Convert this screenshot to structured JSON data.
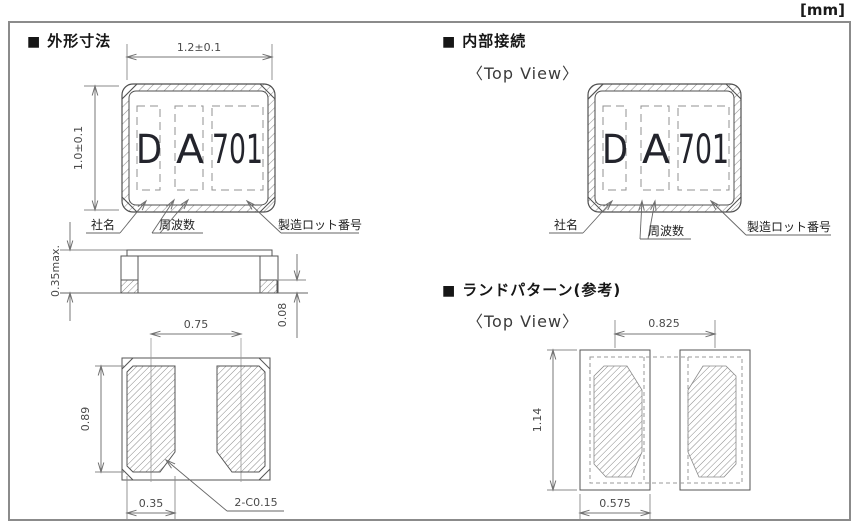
{
  "unit_label": "[mm]",
  "sections": {
    "outline": {
      "marker": "■",
      "title": "外形寸法",
      "package_marking": {
        "company_code": "D",
        "frequency_code": "A",
        "lot_code": "701"
      },
      "labels": {
        "company": "社名",
        "frequency": "周波数",
        "lot": "製造ロット番号"
      },
      "dimensions": {
        "body_width": "1.2±0.1",
        "body_height": "1.0±0.1",
        "thickness": "0.35max.",
        "electrode_height": "0.08",
        "pad_pitch": "0.75",
        "pad_length": "0.89",
        "pad_width": "0.35",
        "chamfer": "2-C0.15"
      }
    },
    "internal_connection": {
      "marker": "■",
      "title": "内部接続",
      "view_label": "〈Top View〉",
      "package_marking": {
        "company_code": "D",
        "frequency_code": "A",
        "lot_code": "701"
      },
      "labels": {
        "company": "社名",
        "frequency": "周波数",
        "lot": "製造ロット番号"
      }
    },
    "land_pattern": {
      "marker": "■",
      "title": "ランドパターン(参考)",
      "view_label": "〈Top View〉",
      "dimensions": {
        "pad_pitch": "0.825",
        "pad_height": "1.14",
        "pad_width": "0.575"
      }
    }
  }
}
